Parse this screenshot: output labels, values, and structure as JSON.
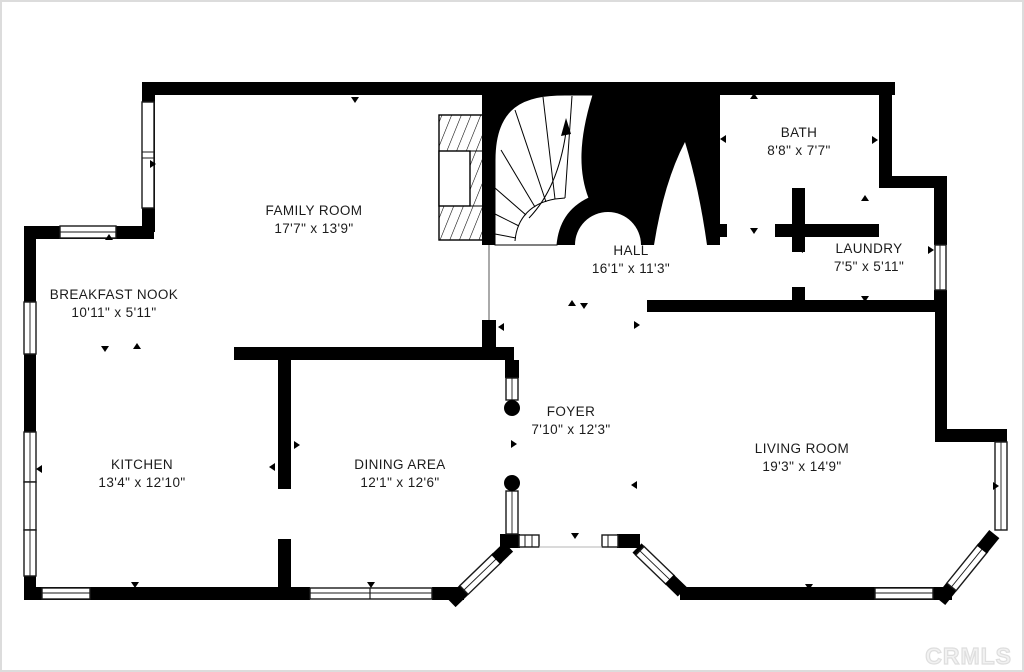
{
  "watermark": "CRMLS",
  "rooms": [
    {
      "id": "family-room",
      "name": "FAMILY ROOM",
      "dims": "17'7\" x 13'9\""
    },
    {
      "id": "bath",
      "name": "BATH",
      "dims": "8'8\" x 7'7\""
    },
    {
      "id": "laundry",
      "name": "LAUNDRY",
      "dims": "7'5\" x 5'11\""
    },
    {
      "id": "hall",
      "name": "HALL",
      "dims": "16'1\" x 11'3\""
    },
    {
      "id": "breakfast-nook",
      "name": "BREAKFAST NOOK",
      "dims": "10'11\" x 5'11\""
    },
    {
      "id": "kitchen",
      "name": "KITCHEN",
      "dims": "13'4\" x 12'10\""
    },
    {
      "id": "dining-area",
      "name": "DINING AREA",
      "dims": "12'1\" x 12'6\""
    },
    {
      "id": "foyer",
      "name": "FOYER",
      "dims": "7'10\" x 12'3\""
    },
    {
      "id": "living-room",
      "name": "LIVING ROOM",
      "dims": "19'3\" x 14'9\""
    }
  ],
  "colors": {
    "wall": "#000000",
    "background": "#ffffff",
    "watermark": "#ededed"
  }
}
